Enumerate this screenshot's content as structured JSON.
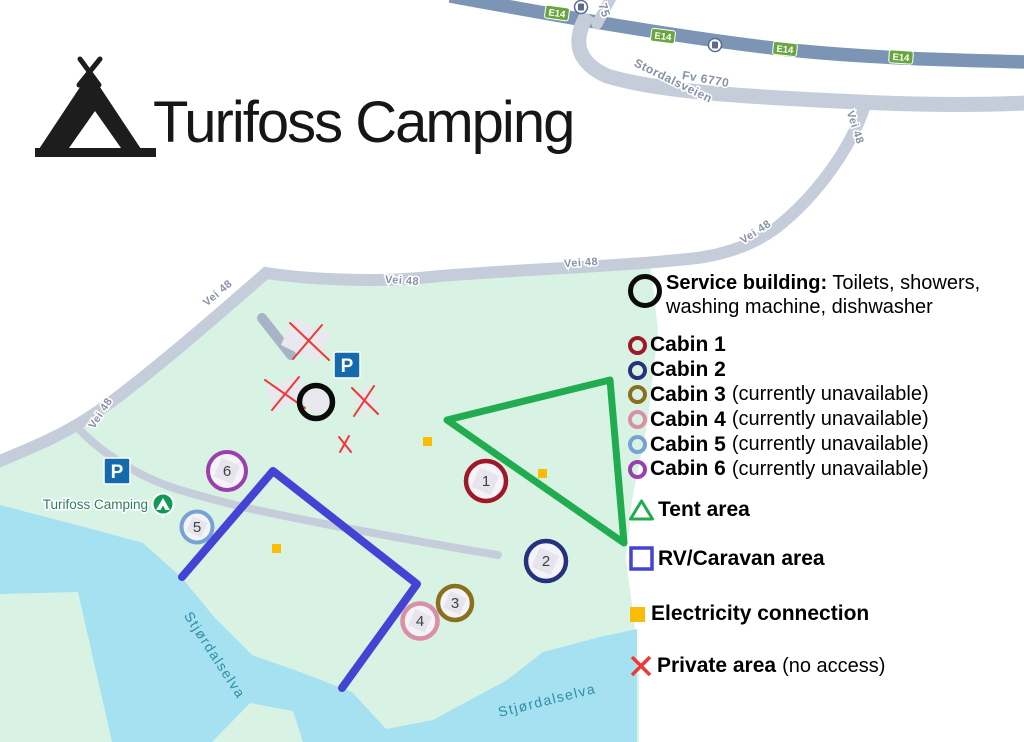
{
  "title": "Turifoss Camping",
  "roads": {
    "e14_badge": "E14",
    "vei48": "Vei 48",
    "stordalsveien": "Stordalsveien",
    "fv_number": "Fv 6770",
    "route75": "75"
  },
  "map": {
    "poi_label": "Turifoss Camping",
    "river_label": "Stjørdalselva",
    "parking": "P",
    "colors": {
      "land": "#d8f3e4",
      "water": "#a5e1f0",
      "road_major": "#7d95b5",
      "road_minor": "#c6cdda",
      "road_drive": "#a9b3c6",
      "badge_green": "#69a63f",
      "parking_blue": "#1569ad",
      "poi_green": "#119a55",
      "service_black": "#0b0b0b"
    }
  },
  "cabins": [
    {
      "number": "1",
      "label": "Cabin 1",
      "note": "",
      "color": "#a01828"
    },
    {
      "number": "2",
      "label": "Cabin 2",
      "note": "",
      "color": "#26317d"
    },
    {
      "number": "3",
      "label": "Cabin 3",
      "note": "(currently unavailable)",
      "color": "#8a701c"
    },
    {
      "number": "4",
      "label": "Cabin 4",
      "note": "(currently unavailable)",
      "color": "#d98fa5"
    },
    {
      "number": "5",
      "label": "Cabin 5",
      "note": "(currently unavailable)",
      "color": "#76a3d4"
    },
    {
      "number": "6",
      "label": "Cabin 6",
      "note": "(currently unavailable)",
      "color": "#9c3fae"
    }
  ],
  "legend": {
    "service": {
      "title": "Service building:",
      "desc_line1": "Toilets, showers,",
      "desc_line2": "washing machine, dishwasher"
    },
    "tent": {
      "label": "Tent area",
      "color": "#21ad4f"
    },
    "rv": {
      "label": "RV/Caravan area",
      "color": "#4343d4"
    },
    "electricity": {
      "label": "Electricity connection",
      "color": "#fbbc04"
    },
    "private": {
      "label": "Private area",
      "note": "(no access)",
      "color": "#ee3a36"
    }
  }
}
